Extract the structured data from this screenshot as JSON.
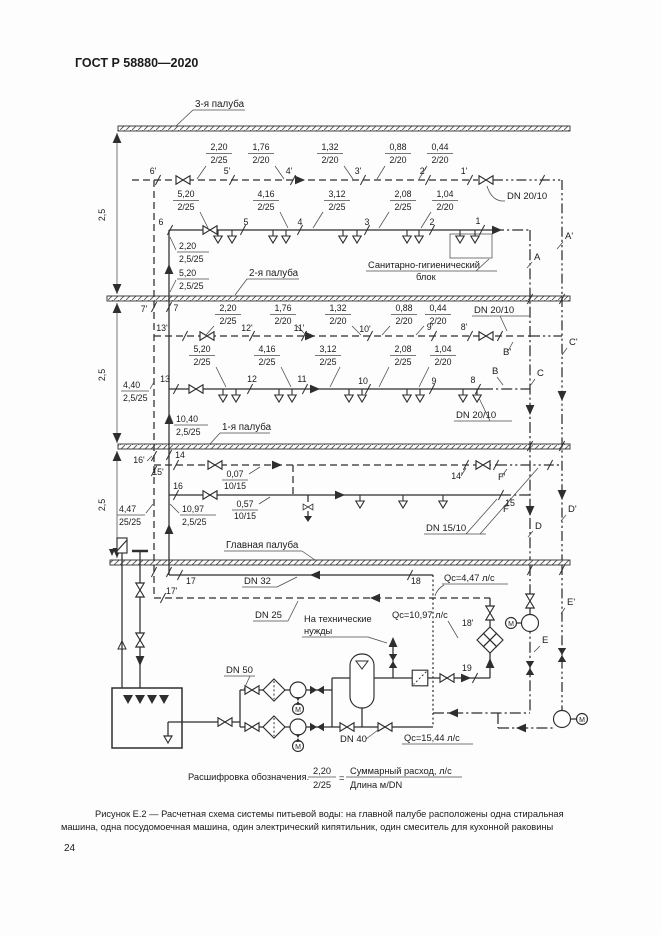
{
  "page": {
    "standard": "ГОСТ Р 58880—2020",
    "number": "24",
    "caption1": "Рисунок Е.2 — Расчетная схема системы питьевой воды: на главной палубе расположены одна стиральная",
    "caption2": "машина, одна посудомоечная машина, один электрический кипятильник, один смеситель для кухонной раковины"
  },
  "decks": {
    "d3": "3-я палуба",
    "d2": "2-я палуба",
    "d1": "1-я палуба",
    "main": "Главная палуба"
  },
  "dims": {
    "v1": "2,5",
    "v2": "2,5",
    "v3": "2,5"
  },
  "legend": {
    "intro": "Расшифровка обозначения.",
    "num": "2,20",
    "den": "2/25",
    "eq": "=",
    "top": "Суммарный расход, л/с",
    "bottom": "Длина  м/DN"
  },
  "flows": {
    "q1": "Qc=4,47 л/с",
    "q2": "Qc=10,97 л/с",
    "q3": "Qc=15,44 л/с"
  },
  "notes": {
    "tech1": "На технические",
    "tech2": "нужды",
    "block1": "Санитарно-гигиенический",
    "block2": "блок"
  },
  "dn": {
    "t1": "DN 20/10",
    "t2top": "DN 20/10",
    "t2bot": "DN 20/10",
    "t3": "DN 15/10",
    "dn32": "DN 32",
    "dn25": "DN 25",
    "dn50": "DN 50",
    "dn40": "DN 40"
  },
  "t1d": {
    "p": [
      "6'",
      "5'",
      "4'",
      "3'",
      "2'",
      "1'"
    ],
    "f": [
      {
        "n": "2,20",
        "d": "2/25"
      },
      {
        "n": "1,76",
        "d": "2/20"
      },
      {
        "n": "1,32",
        "d": "2/20"
      },
      {
        "n": "0,88",
        "d": "2/20"
      },
      {
        "n": "0,44",
        "d": "2/20"
      }
    ]
  },
  "t1s": {
    "p": [
      "6",
      "5",
      "4",
      "3",
      "2",
      "1"
    ],
    "f": [
      {
        "n": "5,20",
        "d": "2/25"
      },
      {
        "n": "4,16",
        "d": "2/25"
      },
      {
        "n": "3,12",
        "d": "2/25"
      },
      {
        "n": "2,08",
        "d": "2/25"
      },
      {
        "n": "1,04",
        "d": "2/20"
      }
    ]
  },
  "t2d": {
    "p": [
      "13'",
      "12'",
      "11'",
      "10'",
      "9'",
      "8'"
    ],
    "f": [
      {
        "n": "2,20",
        "d": "2/25"
      },
      {
        "n": "1,76",
        "d": "2/20"
      },
      {
        "n": "1,32",
        "d": "2/20"
      },
      {
        "n": "0,88",
        "d": "2/20"
      },
      {
        "n": "0,44",
        "d": "2/20"
      }
    ]
  },
  "t2s": {
    "p": [
      "13",
      "12",
      "11",
      "10",
      "9",
      "8"
    ],
    "f": [
      {
        "n": "5,20",
        "d": "2/25"
      },
      {
        "n": "4,16",
        "d": "2/25"
      },
      {
        "n": "3,12",
        "d": "2/25"
      },
      {
        "n": "2,08",
        "d": "2/25"
      },
      {
        "n": "1,04",
        "d": "2/20"
      }
    ]
  },
  "t3d": {
    "p14": "14",
    "p14p": "14'",
    "f": {
      "n": "0,07",
      "d": "10/15"
    }
  },
  "t3s": {
    "p16": "16",
    "p15": "15",
    "f": {
      "n": "0,57",
      "d": "10/15"
    }
  },
  "risers": {
    "p7": "7",
    "p7p": "7'",
    "p15p": "15'",
    "p16p": "16'",
    "p17": "17",
    "p17p": "17'",
    "p18": "18",
    "p18p": "18'",
    "p19": "19",
    "l1": {
      "n": "2,20",
      "d": "2,5/25"
    },
    "l2": {
      "n": "5,20",
      "d": "2,5/25"
    },
    "l3": {
      "n": "4,40",
      "d": "2,5/25"
    },
    "l4": {
      "n": "10,40",
      "d": "2,5/25"
    },
    "l5": {
      "n": "4,47",
      "d": "25/25"
    },
    "l6": {
      "n": "10,97",
      "d": "2,5/25"
    }
  },
  "letters": {
    "a": "A",
    "ap": "A'",
    "b": "B",
    "bp": "B'",
    "c": "C",
    "cp": "C'",
    "d": "D",
    "dp": "D'",
    "e": "E",
    "ep": "E'",
    "f": "F",
    "fp": "F'"
  },
  "motor": "М"
}
